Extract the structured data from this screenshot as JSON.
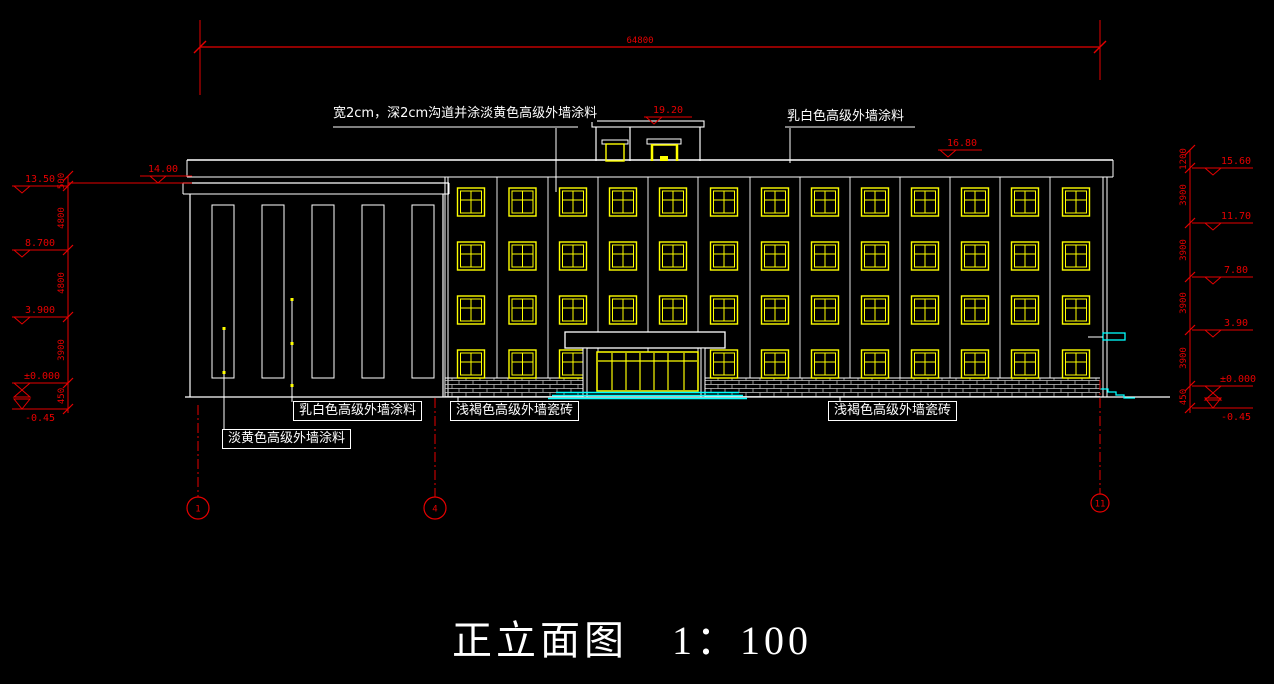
{
  "title": {
    "text": "正立面图　1：100"
  },
  "labels": {
    "groove_note": "宽2cm，深2cm沟道并涂淡黄色高级外墙涂料",
    "offwhite_top": "乳白色高级外墙涂料",
    "offwhite_bottom": "乳白色高级外墙涂料",
    "light_yellow": "淡黄色高级外墙涂料",
    "tile_left": "浅褐色高级外墙瓷砖",
    "tile_right": "浅褐色高级外墙瓷砖"
  },
  "dimensions": {
    "overall_width": "64800",
    "left_chain": [
      "500",
      "4800",
      "4800",
      "3900",
      "450"
    ],
    "right_chain": [
      "1200",
      "3900",
      "3900",
      "3900",
      "3900",
      "450"
    ]
  },
  "elevation_markers": {
    "roof": "19.20",
    "parapet": "16.80",
    "left": [
      "14.00",
      "13.50",
      "8.700",
      "3.900",
      "±0.000",
      "-0.45"
    ],
    "right": [
      "15.60",
      "11.70",
      "7.80",
      "3.90",
      "±0.000",
      "-0.45"
    ]
  },
  "axes": [
    "1",
    "4",
    "11"
  ],
  "colors": {
    "background": "#000000",
    "line": "#ffffff",
    "window": "#ffff00",
    "dimension": "#e60000",
    "accent": "#00ffff"
  }
}
